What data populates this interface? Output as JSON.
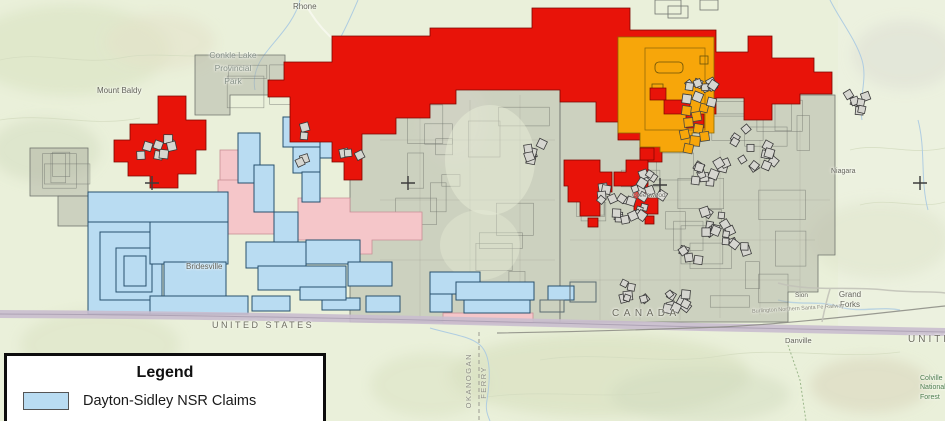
{
  "map": {
    "labels": {
      "rhone": "Rhone",
      "conkle_lake_park": "Conkle Lake\nProvincial\nPark",
      "mount_baldy": "Mount Baldy",
      "bridesville": "Bridesville",
      "greenwood": "Greenwood",
      "niagara": "Niagara",
      "sion": "Sion",
      "grand_forks": "Grand\nForks",
      "danville": "Danville",
      "canada": "CANADA",
      "united_states": "UNITED STATES",
      "united_states_right": "UNITED",
      "colville_nf": "Colville\nNational\nForest",
      "okanogan_county": "OKANOGAN",
      "ferry_county": "FERRY",
      "railway": "Burlington Northern Santa Fe Railway"
    }
  },
  "colors": {
    "dayton_sidley_claims": "#b9dcf2",
    "claim_outline": "#27506d",
    "red_claims": "#e81309",
    "red_outline": "#7a0600",
    "orange_claims": "#f7a60a",
    "orange_outline": "#8a6a00",
    "pink_claims": "#f5c6c9",
    "pink_outline": "#c98f96",
    "parcel_fill": "rgba(168,170,158,0.45)",
    "parcel_outline": "#70756e",
    "crown_grant_fill": "#d6d6d0",
    "crown_grant_outline": "#3a3a3a",
    "border_band": "#c9bdce",
    "terrain": "#eaf0da"
  },
  "legend": {
    "title": "Legend",
    "items": [
      {
        "label": "Dayton-Sidley NSR Claims",
        "color_key": "dayton_sidley_claims"
      }
    ]
  }
}
